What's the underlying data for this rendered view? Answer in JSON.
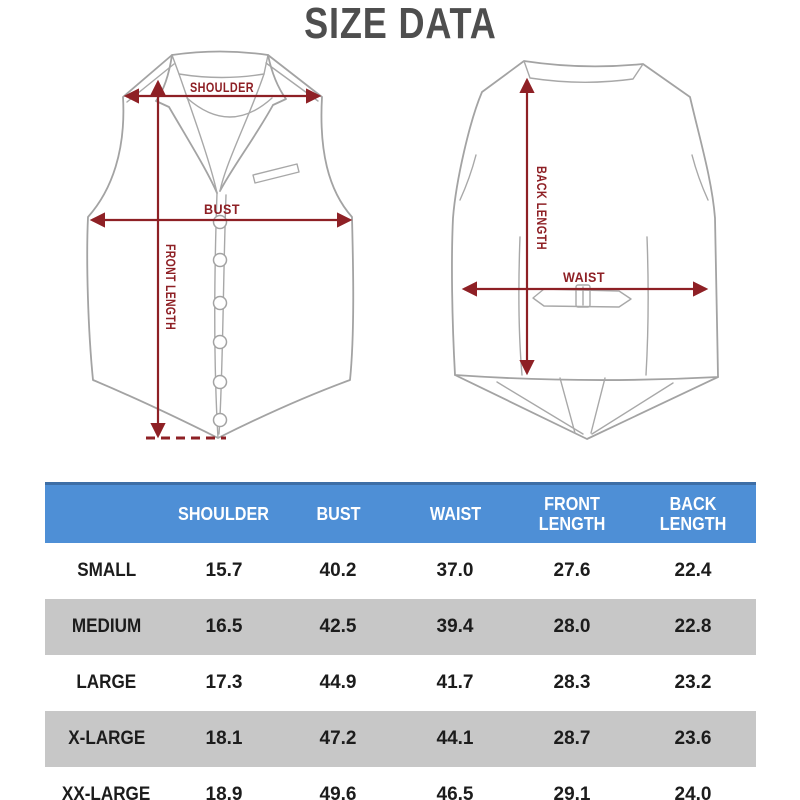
{
  "title": "SIZE DATA",
  "diagram": {
    "front": {
      "labels": {
        "shoulder": "SHOULDER",
        "bust": "BUST",
        "front_length": "FRONT LENGTH"
      }
    },
    "back": {
      "labels": {
        "back_length": "BACK LENGTH",
        "waist": "WAIST"
      }
    }
  },
  "table": {
    "headers": [
      "",
      "SHOULDER",
      "BUST",
      "WAIST",
      "FRONT LENGTH",
      "BACK LENGTH"
    ],
    "rows": [
      {
        "size": "SMALL",
        "values": [
          "15.7",
          "40.2",
          "37.0",
          "27.6",
          "22.4"
        ]
      },
      {
        "size": "MEDIUM",
        "values": [
          "16.5",
          "42.5",
          "39.4",
          "28.0",
          "22.8"
        ]
      },
      {
        "size": "LARGE",
        "values": [
          "17.3",
          "44.9",
          "41.7",
          "28.3",
          "23.2"
        ]
      },
      {
        "size": "X-LARGE",
        "values": [
          "18.1",
          "47.2",
          "44.1",
          "28.7",
          "23.6"
        ]
      },
      {
        "size": "XX-LARGE",
        "values": [
          "18.9",
          "49.6",
          "46.5",
          "29.1",
          "24.0"
        ]
      }
    ]
  },
  "colors": {
    "header_blue": "#4e8fd6",
    "header_top_border": "#3d6ea6",
    "alt_row_gray": "#c7c7c7",
    "measurement_red": "#8e2025",
    "title_gray": "#4e4e4e",
    "line_art_gray": "#a3a3a3"
  }
}
